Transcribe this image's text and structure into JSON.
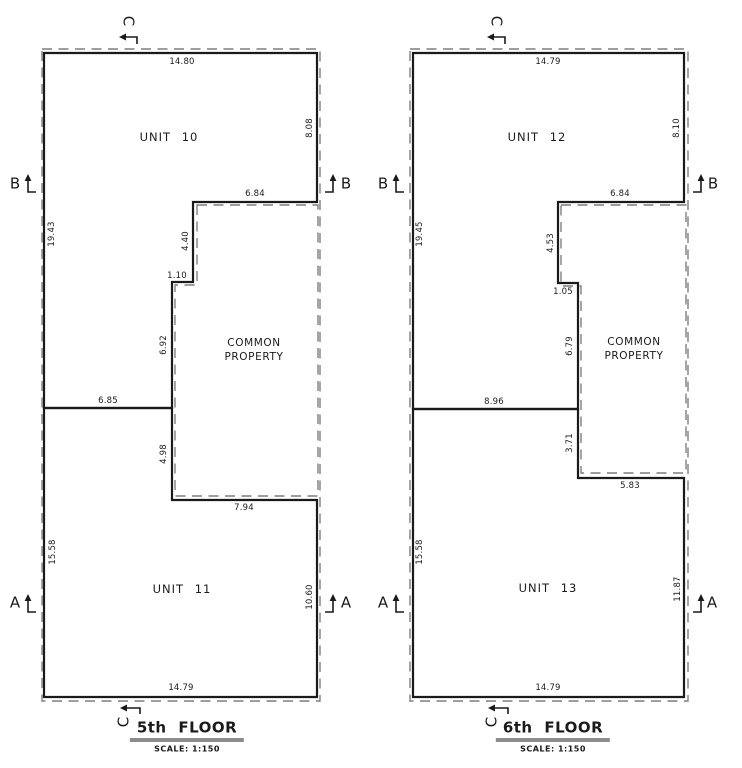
{
  "plans": [
    {
      "title": "5th FLOOR",
      "scale": "SCALE: 1:150",
      "unit_top": "UNIT 10",
      "unit_bottom": "UNIT 11",
      "common_property_line1": "COMMON",
      "common_property_line2": "PROPERTY",
      "markers": {
        "c_top": "C",
        "b_left": "B",
        "b_right": "B",
        "a_left": "A",
        "a_right": "A",
        "c_bottom": "C"
      },
      "dims": {
        "top": "14.80",
        "right_upper": "8.08",
        "notch_width": "6.84",
        "notch_drop": "4.40",
        "step": "1.10",
        "cp_side_upper": "6.92",
        "divider": "6.85",
        "cp_side_lower": "4.98",
        "cp_bottom": "7.94",
        "left_upper": "19.43",
        "left_lower": "15.58",
        "right_lower": "10.60",
        "bottom": "14.79"
      }
    },
    {
      "title": "6th FLOOR",
      "scale": "SCALE: 1:150",
      "unit_top": "UNIT 12",
      "unit_bottom": "UNIT 13",
      "common_property_line1": "COMMON",
      "common_property_line2": "PROPERTY",
      "markers": {
        "c_top": "C",
        "b_left": "B",
        "b_right": "B",
        "a_left": "A",
        "a_right": "A",
        "c_bottom": "C"
      },
      "dims": {
        "top": "14.79",
        "right_upper": "8.10",
        "notch_width": "6.84",
        "notch_drop": "4.53",
        "step": "1.05",
        "cp_side_upper": "6.79",
        "divider": "8.96",
        "cp_side_lower": "3.71",
        "cp_bottom": "5.83",
        "left_upper": "19.45",
        "left_lower": "15.58",
        "right_lower": "11.87",
        "bottom": "14.79"
      }
    }
  ],
  "colors": {
    "line": "#1a1a1a",
    "dashed": "#7f7f7f",
    "background": "#ffffff"
  }
}
